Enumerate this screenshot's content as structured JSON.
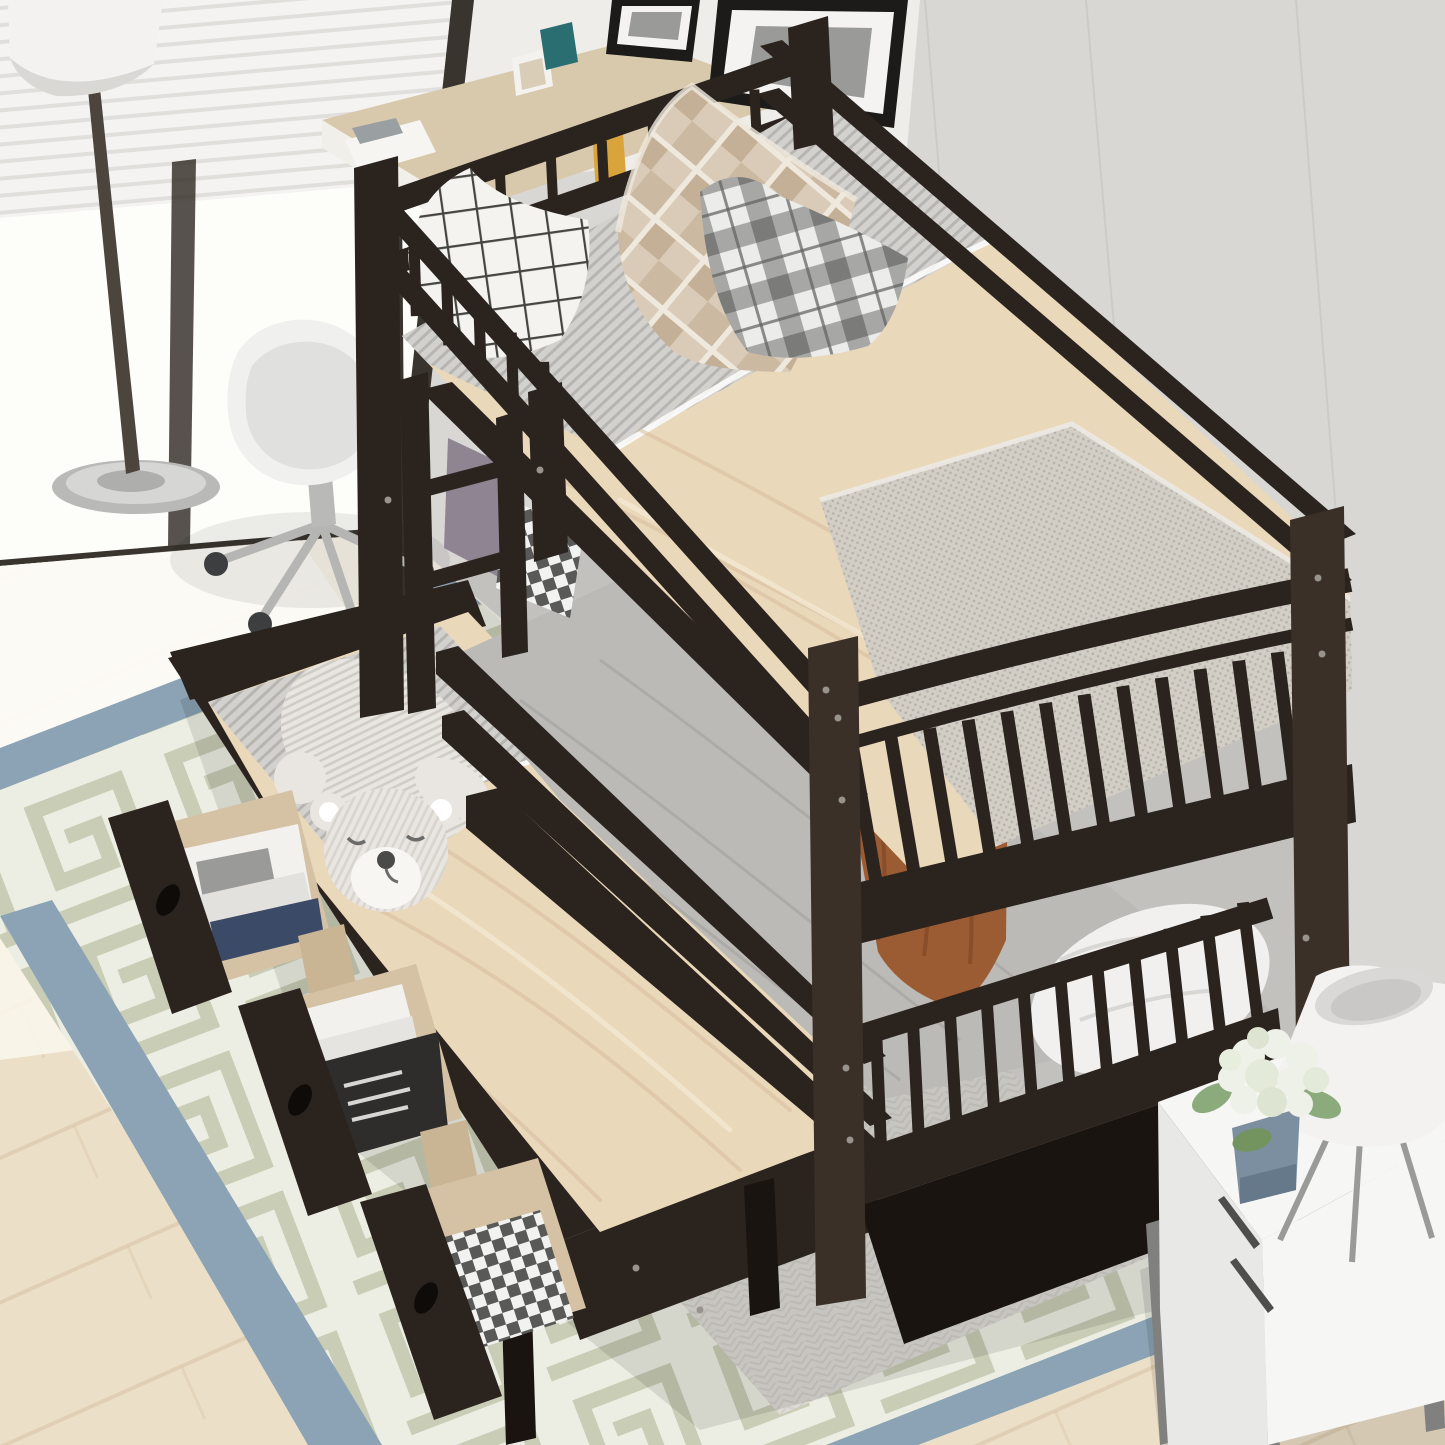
{
  "scene": {
    "title": "Twin over twin bunk bed with trundle and storage drawers",
    "description": "Overhead view of an espresso wood twin-over-twin bunk bed with guardrails, ladder, arched spindle footboards, a pulled-out trundle bed with a sleeping teddy bear plush, and three open storage drawers holding books and plaid clothes. Room styled with a window with blinds, floor lamp, white desk chair, picture frames, Greek-key area rug, and a white nightstand with a tripod lamp and white hydrangea plant.",
    "setting": "bright bedroom corner with light wood floor and grey walls"
  },
  "objects": [
    {
      "name": "bunk-bed-frame",
      "label": "espresso twin-over-twin bunk bed"
    },
    {
      "name": "top-bunk-mattress",
      "label": "top bunk with beige sheet and grey knit foot blanket"
    },
    {
      "name": "lower-bunk-mattress",
      "label": "lower bunk with grey fitted sheet and white pillow"
    },
    {
      "name": "trundle-bed",
      "label": "pulled-out trundle with beige sheet"
    },
    {
      "name": "teddy-bear-plush",
      "label": "striped sleeping teddy bear"
    },
    {
      "name": "storage-drawer-books-1",
      "label": "open drawer with magazines"
    },
    {
      "name": "storage-drawer-books-2",
      "label": "open drawer with upright books"
    },
    {
      "name": "storage-drawer-clothes",
      "label": "open drawer with plaid clothes"
    },
    {
      "name": "pillow-white-grid",
      "label": "white windowpane pillow"
    },
    {
      "name": "pillow-tan-diamond",
      "label": "tan diamond-pattern pillow"
    },
    {
      "name": "pillow-grey-plaid",
      "label": "grey plaid pillow"
    },
    {
      "name": "pillow-gingham-small",
      "label": "black-white gingham mini pillow"
    },
    {
      "name": "blanket-brown",
      "label": "rust brown blanket hanging from top bunk"
    },
    {
      "name": "area-rug",
      "label": "cream Greek-key rug with blue border"
    },
    {
      "name": "floor-lamp",
      "label": "white drum floor lamp with chrome base"
    },
    {
      "name": "desk-chair",
      "label": "white shell office chair with casters"
    },
    {
      "name": "desk",
      "label": "wood-top desk with papers"
    },
    {
      "name": "window-blinds",
      "label": "bright window with white blinds"
    },
    {
      "name": "picture-frames",
      "label": "black picture frames with grey art"
    },
    {
      "name": "nightstand",
      "label": "white two-drawer nightstand on metal legs"
    },
    {
      "name": "table-lamp",
      "label": "white cone tripod table lamp"
    },
    {
      "name": "plant-hydrangea",
      "label": "white hydrangea in blue-grey pot"
    }
  ],
  "palette": {
    "wall_grey": "#d8d7d4",
    "wall_white": "#efede9",
    "wall_seam": "#c7c6c3",
    "frame_dark": "#39342e",
    "glass_light": "#fdfdfa",
    "blind_white": "#f4f3f1",
    "blind_line": "#e0dfdc",
    "floor_wood": "#ecdfc8",
    "floor_bright": "#faf5ea",
    "plank": "#dbc9ab",
    "rug_cream": "#edeee3",
    "rug_key": "#c6cab2",
    "rug_blue": "#8ba3b4",
    "rug_grey": "#dedcd6",
    "rug_chevron": "#cfccc6",
    "bed_dark": "#2b231e",
    "bed_darker": "#1a1410",
    "bed_mid": "#3a3028",
    "bed_edge": "#4a3e33",
    "mattress_beige": "#ead8bb",
    "mattress_beige_dk": "#d5bd9c",
    "sheet_fold": "#f4e8d2",
    "ticking": "#d3d1cd",
    "ticking_line": "#b7b5b1",
    "knit": "#d2cec6",
    "knit_dot": "#b6b1a7",
    "pillow_white": "#f4f3f0",
    "grid_line": "#45443f",
    "tan_base": "#d9cbb8",
    "tan_dark": "#bfa98f",
    "tan_white": "#efe9dd",
    "plaid_base": "#ececea",
    "plaid_grey": "#9b9b99",
    "plaid_dark": "#5f5f5d",
    "gingham_base": "#f2f2f0",
    "gingham_dark": "#3e3e3c",
    "lower_sheet": "#bcbab6",
    "lower_sheet_dk": "#a3a19d",
    "purple_pillow": "#8e8492",
    "white_pillow": "#f1f0ee",
    "brown_blanket": "#9c5c33",
    "brown_dk": "#7a4423",
    "bear": "#e9e6e1",
    "bear_stripe": "#cfccc6",
    "bear_muzzle": "#f8f6f3",
    "bear_nose": "#4a4a48",
    "wood_drawer": "#d5c2a5",
    "wood_runner": "#c9b493",
    "book_white": "#f2f1ee",
    "book_dark": "#2f2d2b",
    "book_blue": "#3b4a66",
    "art_grey": "#9a9a98",
    "night_white": "#f6f6f4",
    "night_side": "#e8e8e6",
    "night_leg": "#80807e",
    "lamp_shade": "#f3f2f0",
    "lamp_inner": "#d9d8d6",
    "chrome": "#b9b9b7",
    "chrome_dk": "#8f8f8d",
    "caster": "#3c3e40",
    "chair_white": "#f0f0ee",
    "chair_inner": "#e0e1df",
    "teal_card": "#2a6e72",
    "yellow_card": "#d9a43c",
    "pot_blue": "#7b8fa1",
    "flower": "#eef1e7",
    "flower_dk": "#dce4d1",
    "plant_green": "#8cab7c",
    "plant_green_dk": "#74945f",
    "screw": "#98938c"
  },
  "decor": {
    "spindle_rows": [
      {
        "name": "upper-footboard-spindles",
        "x1": 834,
        "y1": 756,
        "x2": 1336,
        "y2": 646,
        "x3": 856,
        "y3": 880,
        "x4": 1350,
        "y4": 762,
        "n": 13,
        "w": 13
      },
      {
        "name": "lower-footboard-spindles",
        "x1": 858,
        "y1": 1044,
        "x2": 1262,
        "y2": 902,
        "x3": 862,
        "y3": 1150,
        "x4": 1276,
        "y4": 1008,
        "n": 11,
        "w": 12
      },
      {
        "name": "top-guardrail-spindles",
        "x1": 398,
        "y1": 236,
        "x2": 560,
        "y2": 382,
        "x3": 400,
        "y3": 296,
        "x4": 562,
        "y4": 442,
        "n": 5,
        "w": 11
      },
      {
        "name": "headboard-spindles",
        "x1": 424,
        "y1": 206,
        "x2": 780,
        "y2": 86,
        "x3": 426,
        "y3": 246,
        "x4": 782,
        "y4": 126,
        "n": 7,
        "w": 10
      }
    ],
    "screws": [
      [
        838,
        718
      ],
      [
        842,
        800
      ],
      [
        1318,
        578
      ],
      [
        1322,
        654
      ],
      [
        846,
        1068
      ],
      [
        850,
        1140
      ],
      [
        1306,
        938
      ],
      [
        540,
        470
      ],
      [
        388,
        500
      ],
      [
        636,
        1268
      ],
      [
        700,
        1310
      ],
      [
        826,
        690
      ]
    ]
  }
}
